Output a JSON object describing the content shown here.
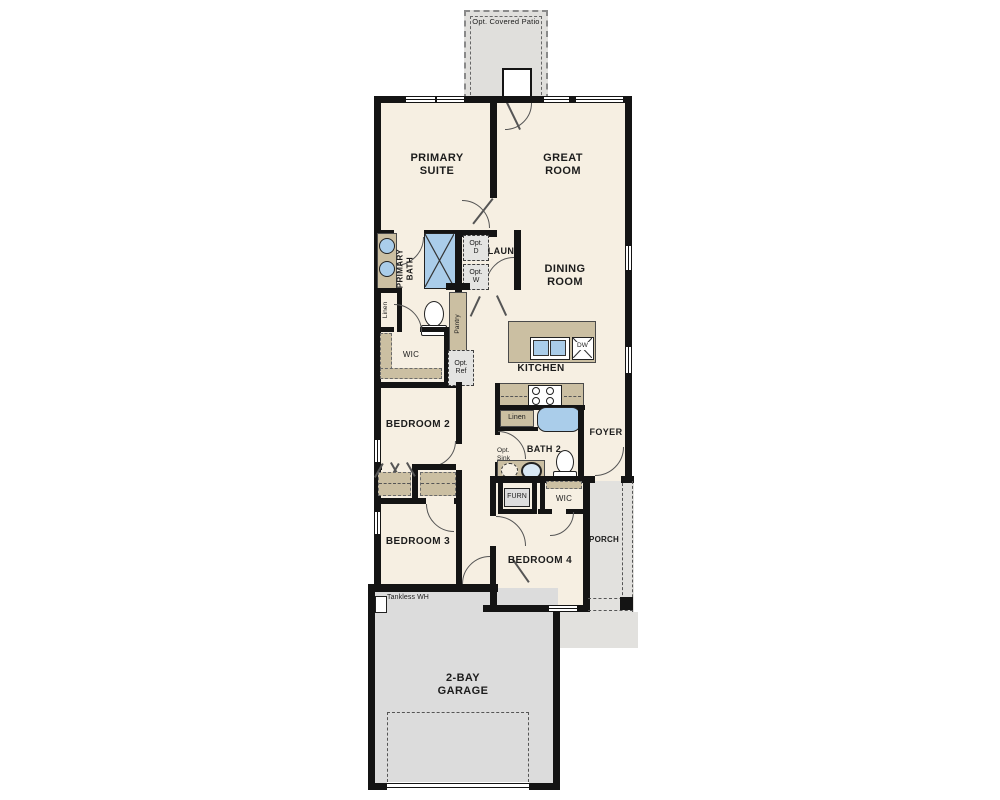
{
  "colors": {
    "wall": "#141414",
    "floor": "#f6efe2",
    "counter": "#cbbfa2",
    "patio": "#e0dfdc",
    "garage": "#dcdcdc",
    "porch": "#e2e1de",
    "blue": "#aacdea",
    "optfill": "#e4e4e2"
  },
  "rooms": {
    "primary_suite": "PRIMARY SUITE",
    "great_room": "GREAT ROOM",
    "dining_room": "DINING ROOM",
    "kitchen": "KITCHEN",
    "laundry": "LAUN",
    "primary_bath": "PRIMARY BATH",
    "wic_primary": "WIC",
    "bedroom2": "BEDROOM 2",
    "bedroom3": "BEDROOM 3",
    "bedroom4": "BEDROOM 4",
    "bath2": "BATH 2",
    "foyer": "FOYER",
    "porch": "PORCH",
    "garage": "2-BAY GARAGE",
    "wic_bedroom4": "WIC",
    "furnace": "FURN"
  },
  "labels": {
    "opt_covered_patio": "Opt. Covered Patio",
    "opt_dryer": "Opt. D",
    "opt_washer": "Opt. W",
    "linen_primary": "Linen",
    "linen_bath2": "Linen",
    "pantry": "Pantry",
    "opt_ref": "Opt. Ref",
    "opt_sink": "Opt. Sink",
    "dishwasher": "DW",
    "tankless_wh": "Tankless WH"
  }
}
